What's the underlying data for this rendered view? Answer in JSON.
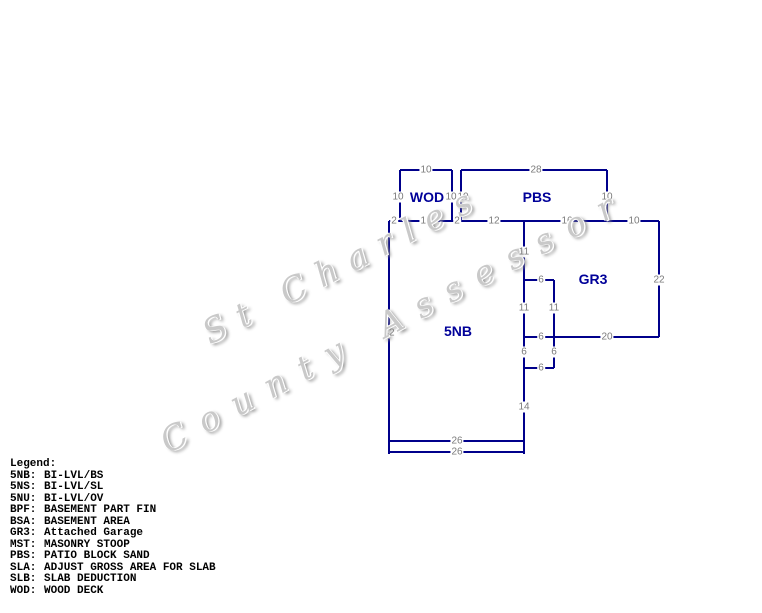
{
  "watermark": {
    "line1": "St Charles",
    "line2": "County Assessor"
  },
  "sketch": {
    "line_color": "#00008B",
    "dimension_color": "#7b7b7b",
    "area_label_color": "#000099",
    "area_labels": [
      {
        "code": "WOD",
        "x": 427,
        "y": 197
      },
      {
        "code": "PBS",
        "x": 537,
        "y": 197
      },
      {
        "code": "GR3",
        "x": 593,
        "y": 279
      },
      {
        "code": "5NB",
        "x": 458,
        "y": 331
      }
    ],
    "dimension_labels": [
      {
        "t": "10",
        "x": 426,
        "y": 170
      },
      {
        "t": "28",
        "x": 536,
        "y": 170
      },
      {
        "t": "10",
        "x": 398,
        "y": 197
      },
      {
        "t": "10",
        "x": 451,
        "y": 197
      },
      {
        "t": "10",
        "x": 463,
        "y": 197
      },
      {
        "t": "10",
        "x": 607,
        "y": 197
      },
      {
        "t": "2",
        "x": 394,
        "y": 221
      },
      {
        "t": "10",
        "x": 426,
        "y": 221
      },
      {
        "t": "2",
        "x": 457,
        "y": 221
      },
      {
        "t": "12",
        "x": 494,
        "y": 221
      },
      {
        "t": "16",
        "x": 567,
        "y": 221
      },
      {
        "t": "10",
        "x": 634,
        "y": 221
      },
      {
        "t": "11",
        "x": 524,
        "y": 252
      },
      {
        "t": "6",
        "x": 541,
        "y": 280
      },
      {
        "t": "22",
        "x": 659,
        "y": 280
      },
      {
        "t": "11",
        "x": 524,
        "y": 308
      },
      {
        "t": "11",
        "x": 554,
        "y": 308
      },
      {
        "t": "42",
        "x": 389,
        "y": 333
      },
      {
        "t": "6",
        "x": 541,
        "y": 337
      },
      {
        "t": "20",
        "x": 607,
        "y": 337
      },
      {
        "t": "6",
        "x": 524,
        "y": 352
      },
      {
        "t": "6",
        "x": 554,
        "y": 352
      },
      {
        "t": "6",
        "x": 541,
        "y": 368
      },
      {
        "t": "14",
        "x": 524,
        "y": 407
      },
      {
        "t": "26",
        "x": 457,
        "y": 441
      },
      {
        "t": "26",
        "x": 457,
        "y": 452
      }
    ],
    "lines": {
      "horizontal": [
        [
          400,
          170,
          52
        ],
        [
          461,
          170,
          146
        ],
        [
          389,
          221,
          270
        ],
        [
          524,
          280,
          30
        ],
        [
          524,
          337,
          135
        ],
        [
          524,
          368,
          30
        ],
        [
          389,
          441,
          135
        ],
        [
          389,
          452,
          135
        ]
      ],
      "vertical": [
        [
          400,
          170,
          51
        ],
        [
          452,
          170,
          51
        ],
        [
          461,
          170,
          51
        ],
        [
          607,
          170,
          51
        ],
        [
          389,
          221,
          233
        ],
        [
          524,
          221,
          233
        ],
        [
          554,
          280,
          88
        ],
        [
          659,
          221,
          116
        ]
      ]
    }
  },
  "legend": {
    "title": "Legend:",
    "entries": [
      {
        "abbr": "5NB:",
        "desc": "BI-LVL/BS"
      },
      {
        "abbr": "5NS:",
        "desc": "BI-LVL/SL"
      },
      {
        "abbr": "5NU:",
        "desc": "BI-LVL/OV"
      },
      {
        "abbr": "BPF:",
        "desc": "BASEMENT PART FIN"
      },
      {
        "abbr": "BSA:",
        "desc": "BASEMENT AREA"
      },
      {
        "abbr": "GR3:",
        "desc": "Attached Garage"
      },
      {
        "abbr": "MST:",
        "desc": "MASONRY STOOP"
      },
      {
        "abbr": "PBS:",
        "desc": "PATIO BLOCK SAND"
      },
      {
        "abbr": "SLA:",
        "desc": "ADJUST GROSS AREA FOR SLAB"
      },
      {
        "abbr": "SLB:",
        "desc": "SLAB DEDUCTION"
      },
      {
        "abbr": "WOD:",
        "desc": "WOOD DECK"
      }
    ]
  }
}
